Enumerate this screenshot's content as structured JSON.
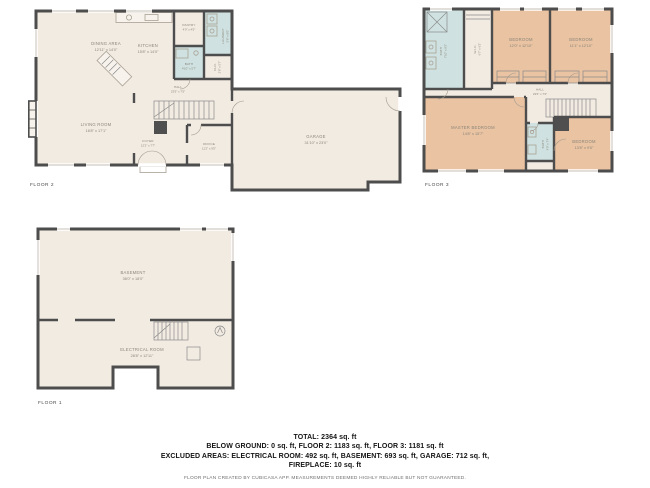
{
  "colors": {
    "wall": "#4d4d4d",
    "floor": "#f2ebe2",
    "wet_room": "#cfe2e1",
    "bedroom": "#e9c3a2",
    "room_label": "#8c8579",
    "footer_text": "#141414",
    "disclaimer_text": "#6f6f6f"
  },
  "floor2": {
    "label": "FLOOR 2",
    "rooms": {
      "dining": {
        "name": "DINING AREA",
        "dims": "12'11\" x 14'0\""
      },
      "kitchen": {
        "name": "KITCHEN",
        "dims": "15'8\" x 14'0\""
      },
      "pantry": {
        "name": "PANTRY",
        "dims": "4'0\" x 4'5\""
      },
      "laundry": {
        "name": "LAUNDRY",
        "dims": "5'8\" x 8'0\""
      },
      "bath": {
        "name": "BATH",
        "dims": "4'10\" x 5'7\""
      },
      "closet": {
        "name": "CLO.",
        "dims": "2'8\" x 5'7\""
      },
      "hall": {
        "name": "HALL",
        "dims": "23'5\" x 7'5\""
      },
      "living": {
        "name": "LIVING ROOM",
        "dims": "16'8\" x 17'1\""
      },
      "foyer": {
        "name": "FOYER",
        "dims": "12'2\" x 7'7\""
      },
      "office": {
        "name": "OFFICE",
        "dims": "11'2\" x 9'5\""
      },
      "garage": {
        "name": "GARAGE",
        "dims": "31'10\" x 23'0\""
      }
    }
  },
  "floor3": {
    "label": "FLOOR 3",
    "rooms": {
      "bath": {
        "name": "BATH",
        "dims": "7'10\" x 8'2\""
      },
      "wic": {
        "name": "W.I.C.",
        "dims": "6'7\" x 6'2\""
      },
      "bedroom1": {
        "name": "BEDROOM",
        "dims": "12'0\" x 12'10\""
      },
      "bedroom2": {
        "name": "BEDROOM",
        "dims": "11'1\" x 12'10\""
      },
      "hall": {
        "name": "HALL",
        "dims": "23'6\" x 7'2\""
      },
      "master": {
        "name": "MASTER BEDROOM",
        "dims": "14'8\" x 15'7\""
      },
      "bath2": {
        "name": "BATH",
        "dims": "4'0\" x 7'4\""
      },
      "bedroom3": {
        "name": "BEDROOM",
        "dims": "13'8\" x 9'5\""
      }
    }
  },
  "floor1": {
    "label": "FLOOR 1",
    "rooms": {
      "basement": {
        "name": "BASEMENT",
        "dims": "36'0\" x 18'0\""
      },
      "electrical": {
        "name": "ELECTRICAL ROOM",
        "dims": "28'8\" x 12'11\""
      }
    }
  },
  "footer": {
    "total": "TOTAL: 2364 sq. ft",
    "line2": "BELOW GROUND: 0 sq. ft, FLOOR 2: 1183 sq. ft, FLOOR 3: 1181 sq. ft",
    "line3": "EXCLUDED AREAS: ELECTRICAL ROOM: 492 sq. ft, BASEMENT: 693 sq. ft, GARAGE: 712 sq. ft,",
    "line4": "FIREPLACE: 10 sq. ft",
    "disclaimer": "FLOOR PLAN CREATED BY CUBICASA APP. MEASUREMENTS DEEMED HIGHLY RELIABLE BUT NOT GUARANTEED."
  }
}
